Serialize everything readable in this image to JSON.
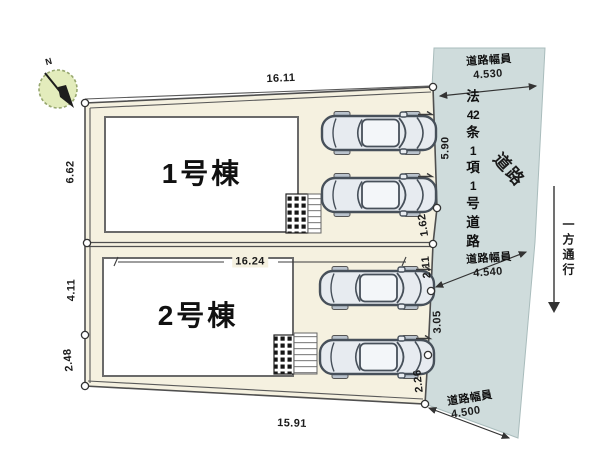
{
  "compass": {
    "north_label": "N"
  },
  "buildings": [
    {
      "label": "1号棟"
    },
    {
      "label": "2号棟"
    }
  ],
  "dimensions": {
    "top": "16.11",
    "middle": "16.24",
    "bottom": "15.91",
    "left": [
      "6.62",
      "4.11",
      "2.48"
    ],
    "right": [
      "5.90",
      "1.62",
      "2.11",
      "3.05",
      "2.26"
    ]
  },
  "road": {
    "label": "道路",
    "classification": "法42条1項1号道路",
    "classification_chars": [
      "法",
      "42",
      "条",
      "1",
      "項",
      "1",
      "号",
      "道",
      "路"
    ],
    "one_way": "一方通行",
    "widths": [
      {
        "caption": "道路幅員",
        "value": "4.530"
      },
      {
        "caption": "道路幅員",
        "value": "4.540"
      },
      {
        "caption": "道路幅員",
        "value": "4.500"
      }
    ]
  },
  "colors": {
    "plot": "#f5f1e0",
    "road": "#cfdcdc",
    "building": "#ffffff",
    "compass_face": "#e3ecbc",
    "line": "#4a4a4a"
  }
}
